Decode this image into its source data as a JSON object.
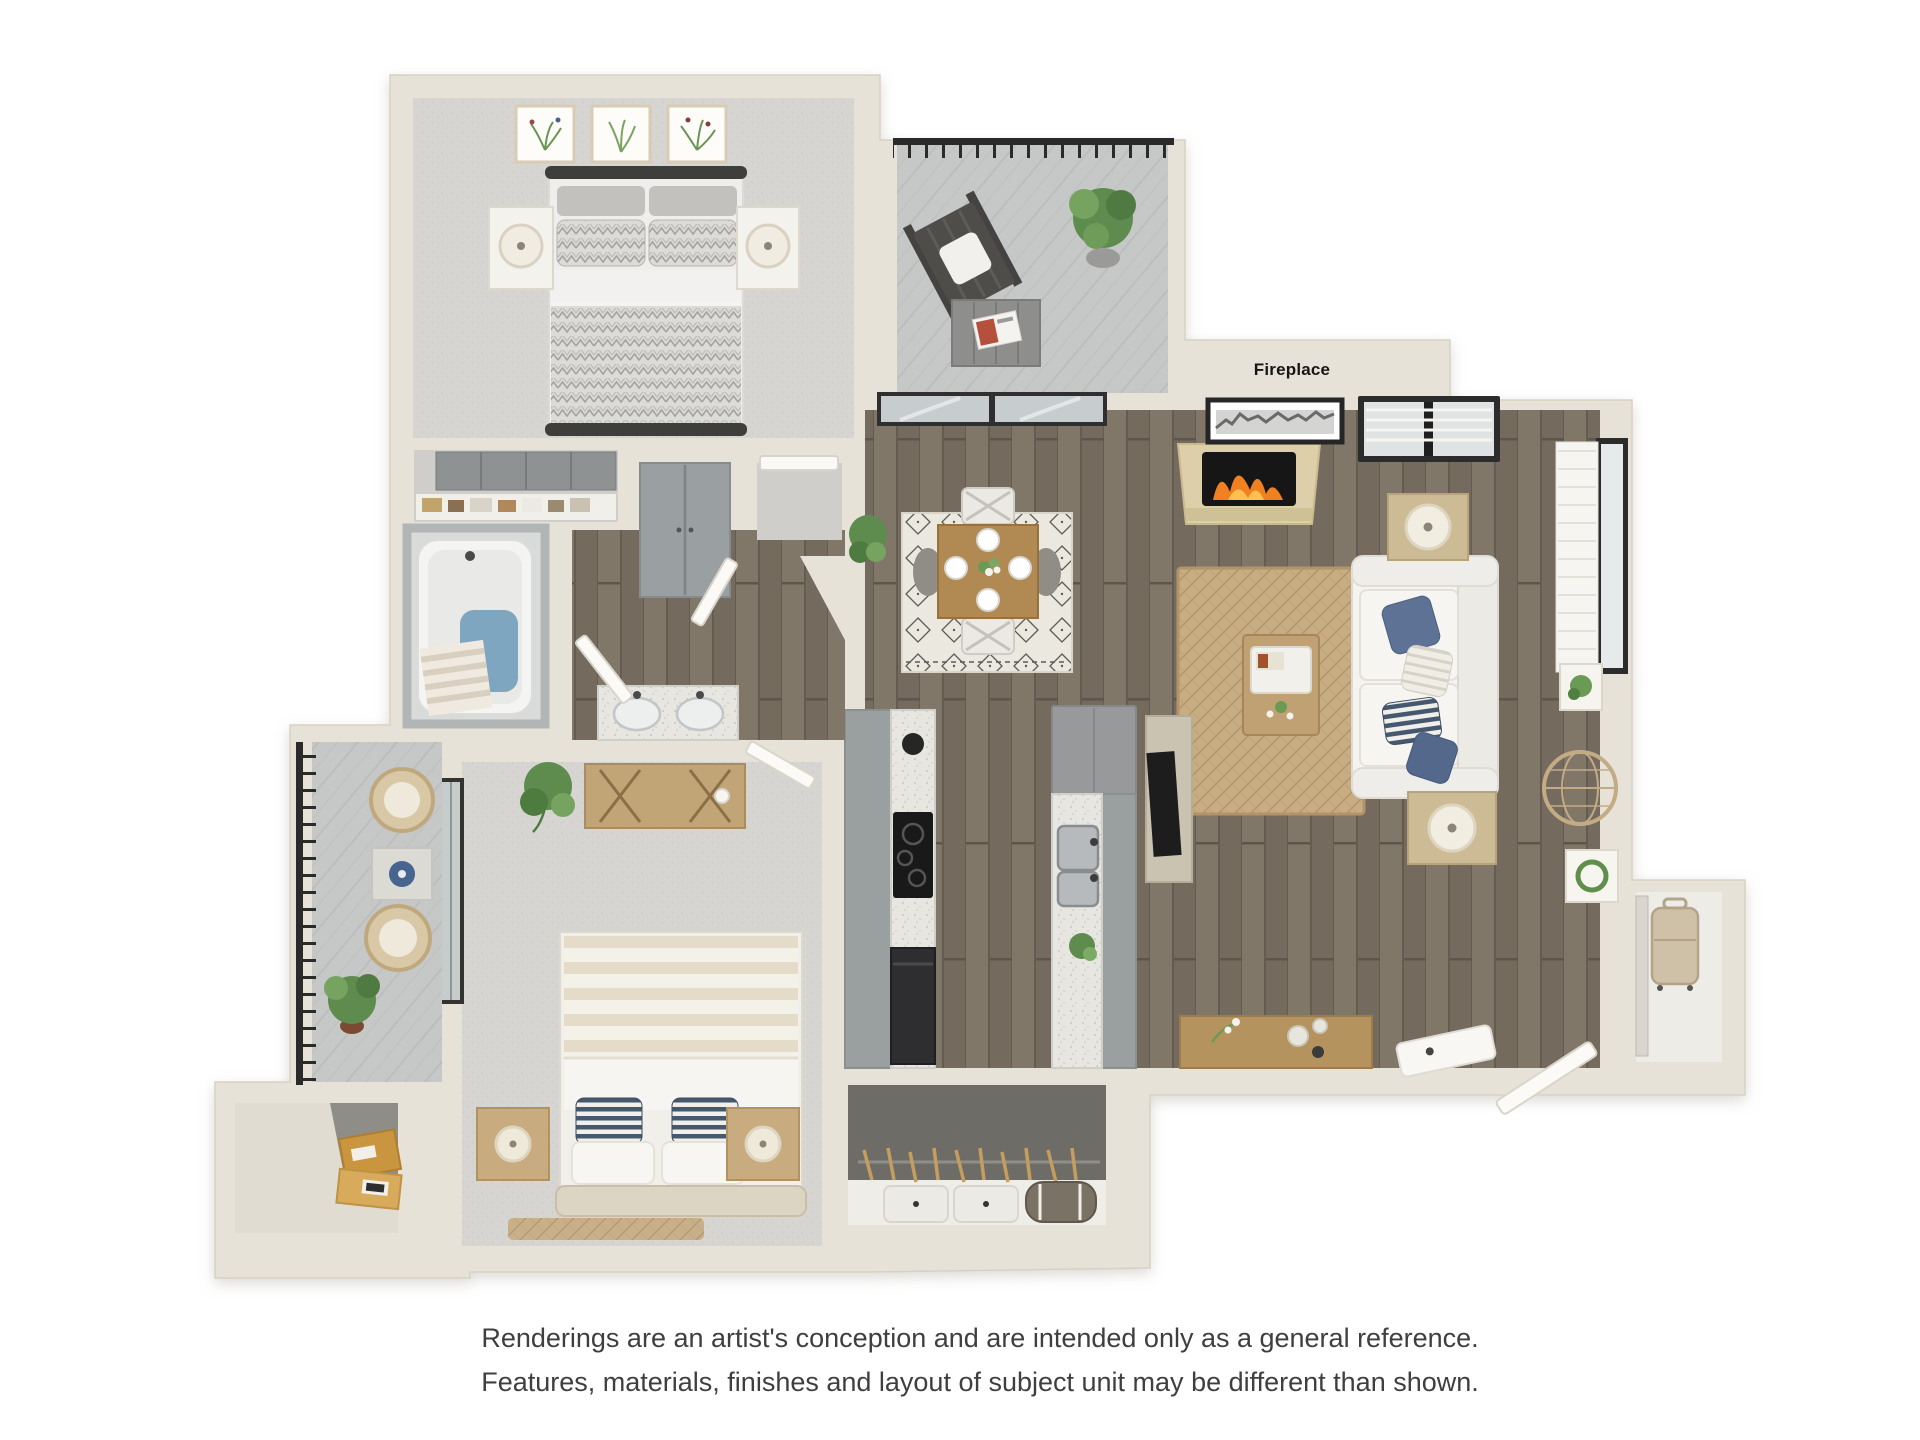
{
  "page": {
    "background": "#ffffff",
    "width": 1920,
    "height": 1440
  },
  "floorplan": {
    "type": "3d-apartment-floor-plan",
    "fireplace_label": "Fireplace",
    "colors": {
      "wall_cream": "#e7e2d8",
      "wood_floor": "#7a7165",
      "bedroom_carpet": "#d6d4d0",
      "balcony_concrete": "#c6c8c7",
      "closet_carpet_dark": "#6e6c66",
      "cabinet_gray": "#9aa0a0",
      "counter_speckle": "#e7e6e1",
      "sofa_white": "#f4f3f0",
      "pillow_blue": "#5e7296",
      "jute_rug_tan": "#c8ac82",
      "dining_rug_cream": "#ebe8df",
      "flame_orange": "#f08020",
      "railing_black": "#2a2a2a",
      "plant_green": "#5e8c4e",
      "tub_water_blue": "#7fa6c0",
      "storage_box_amber": "#c9963f",
      "wood_furniture": "#b9995f"
    }
  },
  "disclaimer": {
    "line1": "Renderings are an artist's conception and are intended only as a general reference.",
    "line2": "Features, materials, finishes and layout of subject unit may be different than shown."
  }
}
